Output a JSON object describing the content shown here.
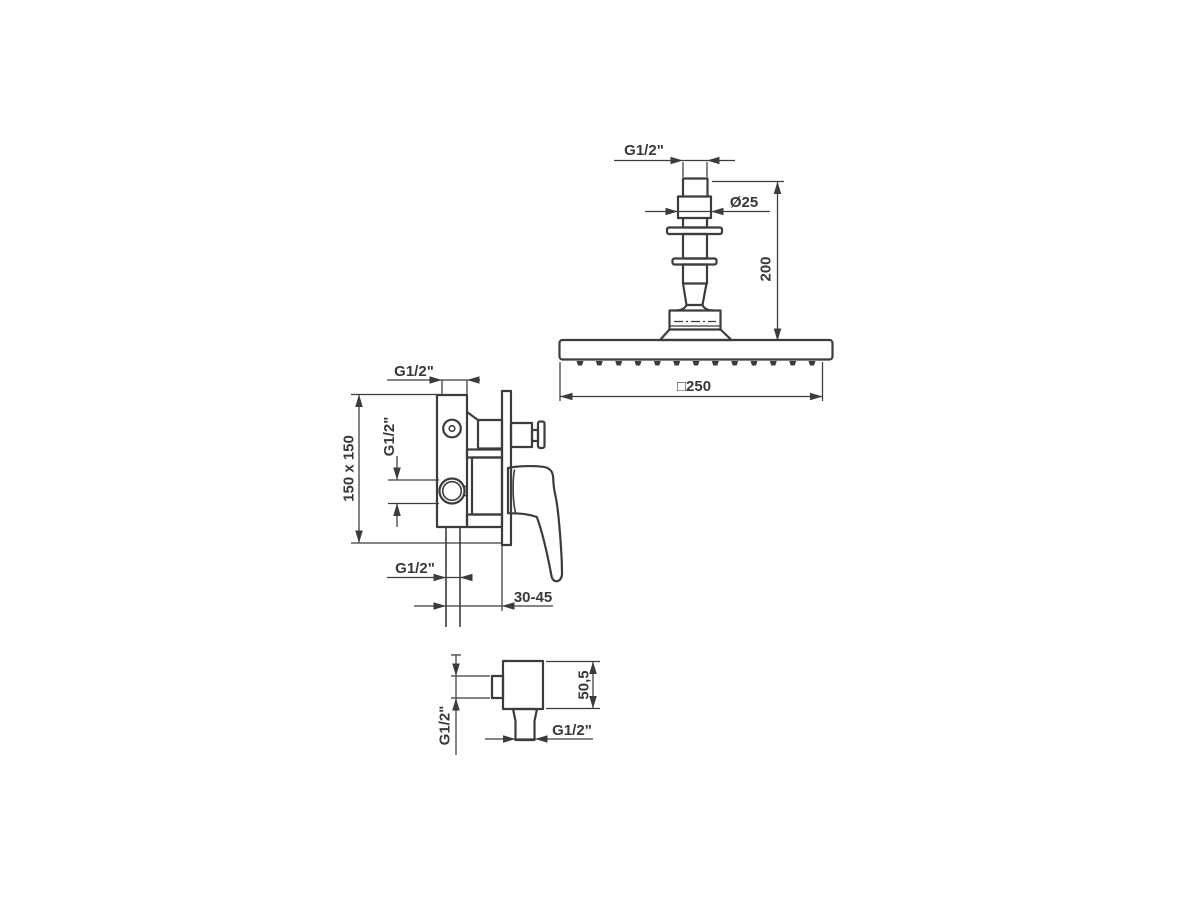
{
  "canvas": {
    "background": "#ffffff",
    "line_color": "#3c3c3c"
  },
  "views": {
    "overhead_shower": {
      "labels": {
        "thread": "G1/2\"",
        "arm_diameter": "Ø25",
        "height": "200",
        "head_width": "□250"
      }
    },
    "mixer": {
      "labels": {
        "top_thread": "G1/2\"",
        "plate_size": "150 x 150",
        "outlet_thread": "G1/2\"",
        "bottom_thread": "G1/2\"",
        "mounting_depth": "30-45"
      }
    },
    "elbow": {
      "labels": {
        "inlet_thread": "G1/2\"",
        "body_height": "50,5",
        "outlet_thread": "G1/2\""
      }
    }
  }
}
